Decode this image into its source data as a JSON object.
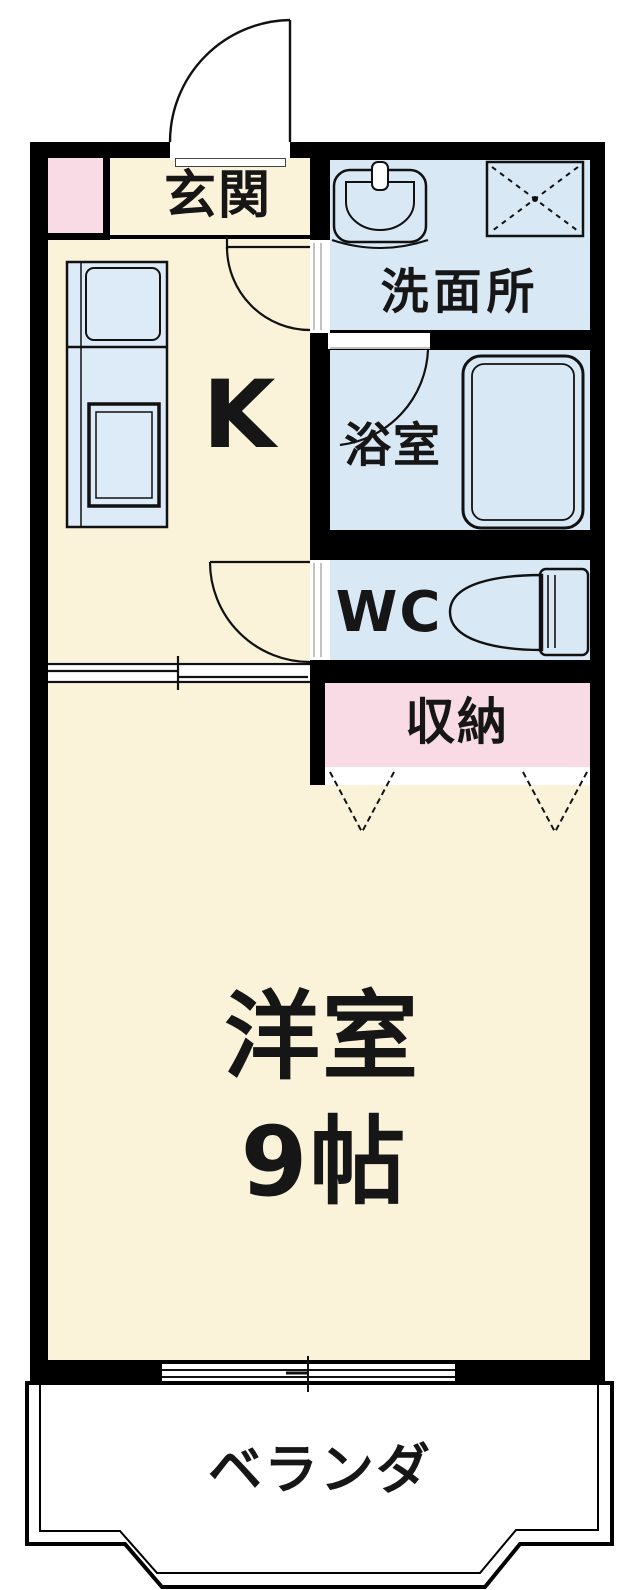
{
  "plan_title": "1K apartment floor plan",
  "rooms": {
    "genkan": {
      "label": "玄関"
    },
    "kitchen": {
      "label": "K"
    },
    "washroom": {
      "label": "洗面所"
    },
    "bathroom": {
      "label": "浴室"
    },
    "wc": {
      "label": "WC"
    },
    "storage": {
      "label": "収納"
    },
    "western_room": {
      "label": "洋室",
      "size_label": "9帖"
    },
    "veranda": {
      "label": "ベランダ"
    }
  },
  "fixtures": {
    "entrance_door": "swing-door",
    "washroom_door": "swing-door",
    "wc_door": "swing-door",
    "bathroom_door": "swing-door",
    "kitchen_partition": "sliding-door",
    "window": "sliding-window",
    "sink": "wash-basin",
    "washer_pan": "washing-machine-pan",
    "bathtub": "bathtub",
    "toilet": "toilet",
    "kitchen_counter": "kitchen-counter",
    "closet_doors": "folding-doors"
  },
  "colors": {
    "wall": "#000000",
    "room": "#fbf2da",
    "water": "#d9e8f5",
    "storage": "#f8dbe4",
    "line": "#1a1a1a"
  }
}
